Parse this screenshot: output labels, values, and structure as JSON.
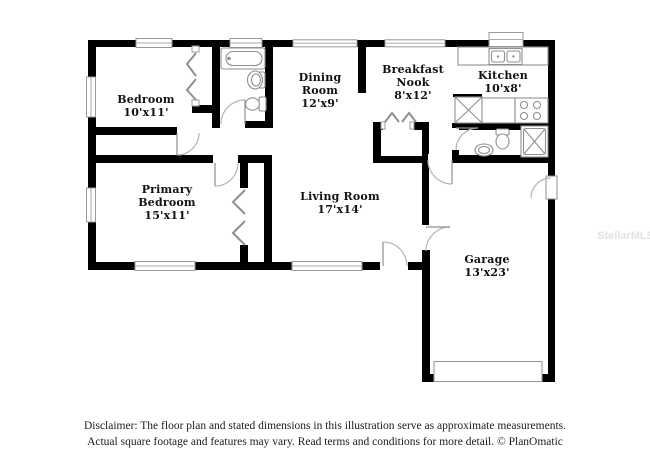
{
  "title": "Floor plan illustration",
  "rooms": [
    {
      "name": "Bedroom",
      "dims": "10'x11'"
    },
    {
      "name": "Dining Room",
      "dims": "12'x9'"
    },
    {
      "name": "Breakfast Nook",
      "dims": "8'x12'"
    },
    {
      "name": "Kitchen",
      "dims": "10'x8'"
    },
    {
      "name": "Primary Bedroom",
      "dims": "15'x11'"
    },
    {
      "name": "Living Room",
      "dims": "17'x14'"
    },
    {
      "name": "Garage",
      "dims": "13'x23'"
    }
  ],
  "fixtures": {
    "hall_bathroom": [
      "bathtub",
      "pedestal-sink",
      "toilet"
    ],
    "kitchen": [
      "double-sink",
      "refrigerator",
      "countertop",
      "stove"
    ],
    "second_bathroom": [
      "toilet",
      "pedestal-sink",
      "shower"
    ],
    "garage": [
      "garage-door"
    ]
  },
  "watermark": "StellarMLS",
  "disclaimer": {
    "line1": "Disclaimer: The floor plan and stated dimensions in this illustration serve as approximate measurements.",
    "line2": "Actual square footage and features may vary. Read terms and conditions for more detail. © PlanOmatic"
  },
  "colors": {
    "wall": "#000000",
    "fixture_line": "#8f8f8f",
    "door_arc": "#b5b5b5",
    "window_edge": "#999999",
    "label_text": "#121212",
    "watermark_text": "#e2e2e2",
    "background": "#ffffff"
  }
}
